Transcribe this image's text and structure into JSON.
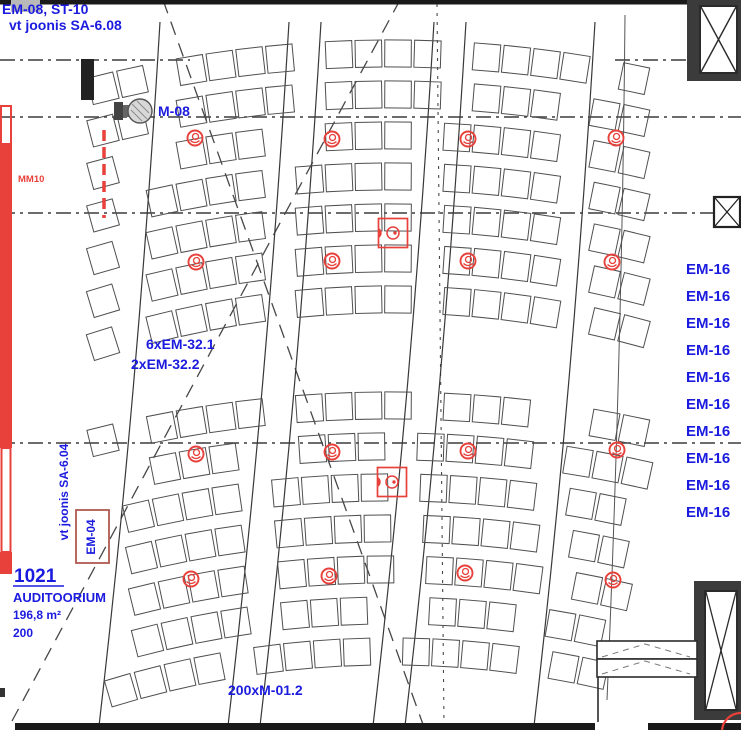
{
  "colors": {
    "annotation_blue": "#1b1bdf",
    "marking_red": "#e8403a",
    "em04_box_red": "#b05a50",
    "line_dark": "#2b2b2b",
    "seat_line": "#4f4f4f",
    "wall_fill": "#3b3b3b",
    "grey_tag_fill": "#b9b9b9"
  },
  "annotations": {
    "top_ref_line1": "EM-08, ST-10",
    "top_ref_line2": "vt joonis SA-6.08",
    "device_label": "M-08",
    "mm10_label": "MM10",
    "fixture_count_1": "6xEM-32.1",
    "fixture_count_2": "2xEM-32.2",
    "side_ref": "vt joonis SA-6.04",
    "em04_label": "EM-04",
    "seat_type_label": "200xM-01.2"
  },
  "room": {
    "number": "1021",
    "name": "AUDITOORIUM",
    "area": "196,8 m²",
    "capacity": "200"
  },
  "em16_list": [
    "EM-16",
    "EM-16",
    "EM-16",
    "EM-16",
    "EM-16",
    "EM-16",
    "EM-16",
    "EM-16",
    "EM-16",
    "EM-16"
  ],
  "symbols": {
    "ceiling_fixtures": [
      [
        195,
        138
      ],
      [
        332,
        139
      ],
      [
        468,
        139
      ],
      [
        616,
        138
      ],
      [
        196,
        262
      ],
      [
        332,
        261
      ],
      [
        468,
        261
      ],
      [
        612,
        262
      ],
      [
        196,
        454
      ],
      [
        332,
        452
      ],
      [
        468,
        451
      ],
      [
        617,
        450
      ],
      [
        191,
        579
      ],
      [
        329,
        576
      ],
      [
        465,
        573
      ],
      [
        613,
        580
      ]
    ],
    "junction_boxes": [
      [
        393,
        233
      ],
      [
        392,
        482
      ]
    ]
  }
}
